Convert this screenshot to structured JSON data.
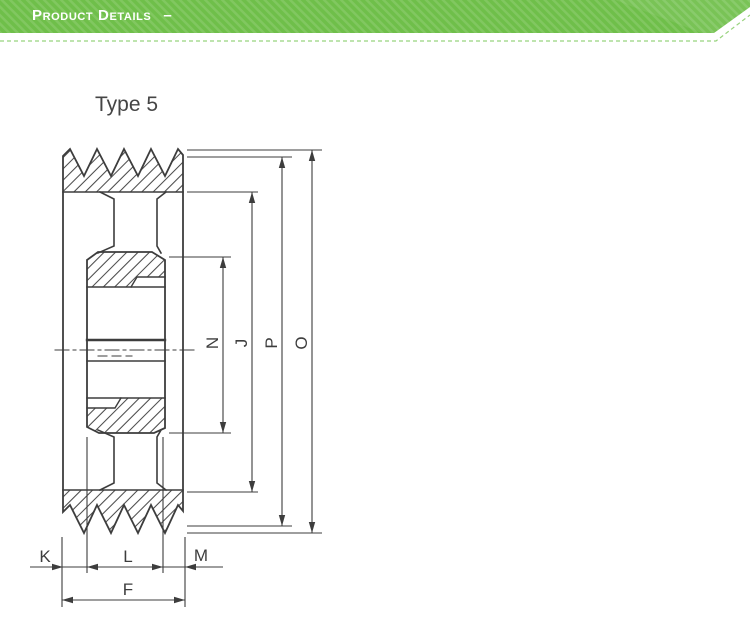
{
  "header": {
    "title": "Product Details",
    "collapse_symbol": "–",
    "colors": {
      "banner_green": "#6fbf4a",
      "banner_stripe_light": "#7cc958",
      "underline_green": "#98d37d",
      "title_text": "#ffffff"
    }
  },
  "diagram": {
    "title": "Type 5",
    "line_color": "#3d3d3d",
    "labels": {
      "k": "K",
      "l": "L",
      "m": "M",
      "f": "F",
      "n": "N",
      "j": "J",
      "p": "P",
      "o": "O"
    }
  }
}
